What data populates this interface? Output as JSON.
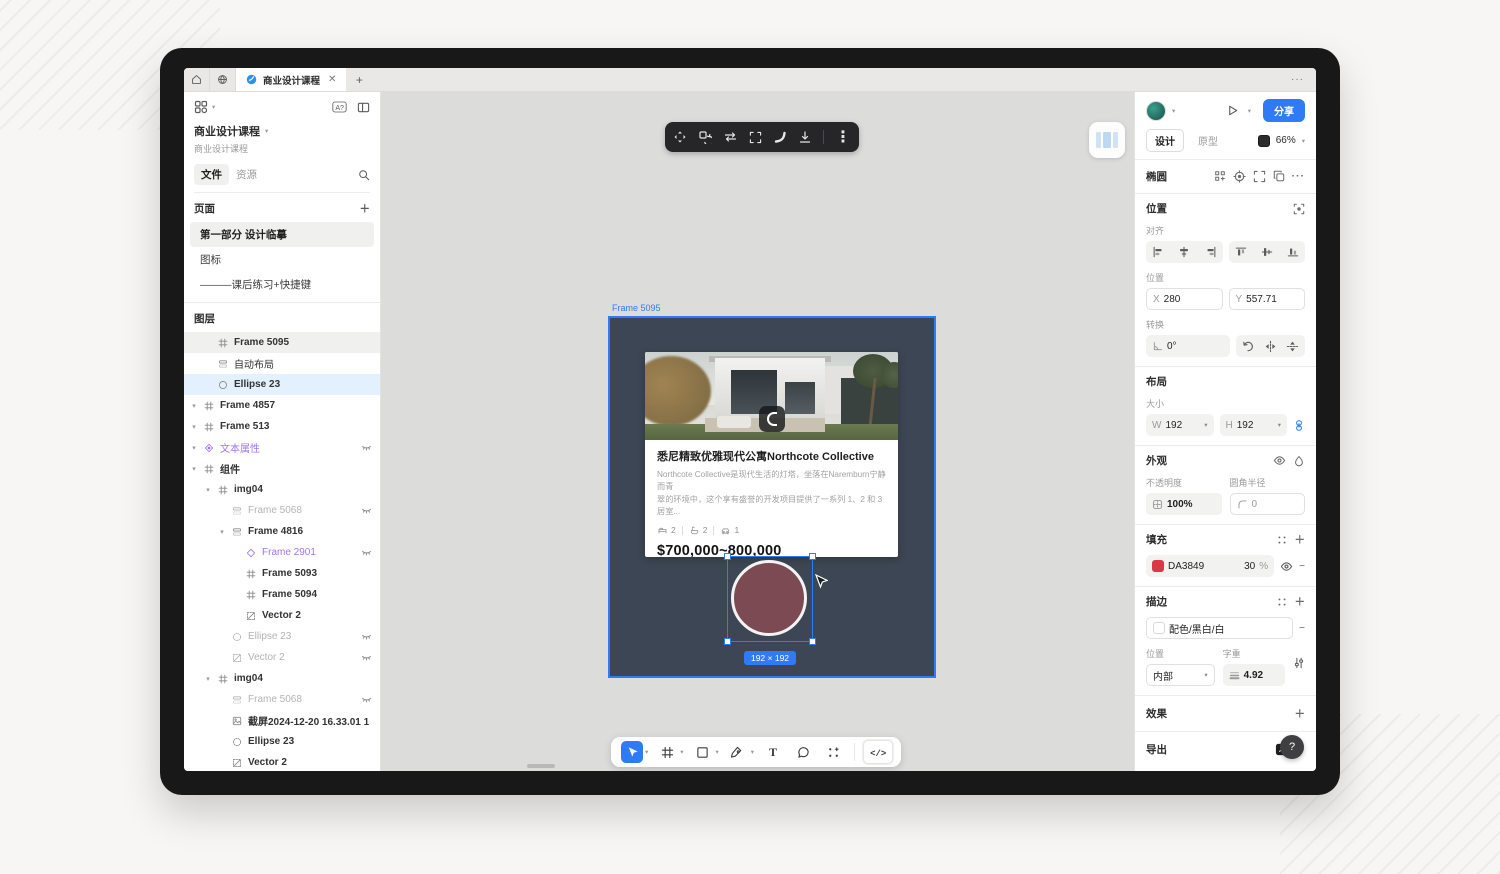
{
  "topbar": {
    "tab_title": "商业设计课程",
    "more": "···"
  },
  "sidebar": {
    "doc_title": "商业设计课程",
    "doc_subtitle": "商业设计课程",
    "tab_files": "文件",
    "tab_assets": "资源",
    "pages_header": "页面",
    "pages": [
      {
        "name": "第一部分 设计临摹",
        "active": true
      },
      {
        "name": "图标",
        "active": false
      },
      {
        "name": "———课后练习+快捷键",
        "active": false
      }
    ],
    "layers_header": "图层",
    "layers": [
      {
        "name": "Frame 5095",
        "indent": 1,
        "icon": "frame",
        "bg": "gray",
        "bold": true
      },
      {
        "name": "自动布局",
        "indent": 1,
        "icon": "autolayout"
      },
      {
        "name": "Ellipse 23",
        "indent": 1,
        "icon": "ellipse",
        "bg": "blue",
        "bold": true
      },
      {
        "name": "Frame 4857",
        "indent": 0,
        "icon": "frame",
        "caret": true,
        "bold": true
      },
      {
        "name": "Frame 513",
        "indent": 0,
        "icon": "frame",
        "caret": true,
        "bold": true
      },
      {
        "name": "文本属性",
        "indent": 0,
        "icon": "component",
        "color": "purple",
        "hidden": true,
        "caret": true
      },
      {
        "name": "组件",
        "indent": 0,
        "icon": "frame",
        "caret": true,
        "bold": true
      },
      {
        "name": "img04",
        "indent": 1,
        "icon": "frame",
        "caret": true,
        "bold": true
      },
      {
        "name": "Frame 5068",
        "indent": 2,
        "icon": "autolayout",
        "color": "gray",
        "hidden": true
      },
      {
        "name": "Frame 4816",
        "indent": 2,
        "icon": "autolayout",
        "caret": true,
        "bold": true
      },
      {
        "name": "Frame 2901",
        "indent": 3,
        "icon": "diamond",
        "color": "purple",
        "hidden": true
      },
      {
        "name": "Frame 5093",
        "indent": 3,
        "icon": "frame",
        "bold": true
      },
      {
        "name": "Frame 5094",
        "indent": 3,
        "icon": "frame",
        "bold": true
      },
      {
        "name": "Vector 2",
        "indent": 3,
        "icon": "vector",
        "bold": true
      },
      {
        "name": "Ellipse 23",
        "indent": 2,
        "icon": "ellipse-dashed",
        "color": "gray",
        "hidden": true
      },
      {
        "name": "Vector 2",
        "indent": 2,
        "icon": "vector",
        "color": "gray",
        "hidden": true
      },
      {
        "name": "img04",
        "indent": 1,
        "icon": "frame",
        "caret": true,
        "bold": true
      },
      {
        "name": "Frame 5068",
        "indent": 2,
        "icon": "autolayout",
        "color": "gray",
        "hidden": true
      },
      {
        "name": "截屏2024-12-20 16.33.01 1",
        "indent": 2,
        "icon": "image",
        "bold": true
      },
      {
        "name": "Ellipse 23",
        "indent": 2,
        "icon": "ellipse-dashed",
        "bold": true
      },
      {
        "name": "Vector 2",
        "indent": 2,
        "icon": "vector",
        "bold": true
      },
      {
        "name": "「框架」可以无限嵌套",
        "indent": 2,
        "icon": "text"
      }
    ]
  },
  "canvas": {
    "frame_label": "Frame 5095",
    "top_tools": [
      "move-icon",
      "rotate-copy-icon",
      "swap-arrows-icon",
      "frame-brackets-icon",
      "curve-icon",
      "export-download-icon",
      "more-vertical-icon"
    ],
    "bottom_tools": [
      {
        "icon": "cursor-icon",
        "active": true,
        "dropdown": true
      },
      {
        "icon": "frame-tool-icon",
        "active": false,
        "dropdown": true
      },
      {
        "icon": "shape-tool-icon",
        "active": false,
        "dropdown": true
      },
      {
        "icon": "pen-tool-icon",
        "active": false,
        "dropdown": true
      },
      {
        "icon": "text-tool-icon",
        "active": false,
        "dropdown": false
      },
      {
        "icon": "comment-tool-icon",
        "active": false,
        "dropdown": false
      },
      {
        "icon": "resources-tool-icon",
        "active": false,
        "dropdown": false
      }
    ],
    "card": {
      "title": "悉尼精致优雅现代公寓Northcote Collective",
      "desc1": "Northcote Collective是现代生活的灯塔，坐落在Naremburn宁静而青",
      "desc2": "翠的环境中，这个享有盛誉的开发项目提供了一系列 1、2 和 3 居室...",
      "amenities": [
        {
          "icon": "bed-icon",
          "count": "2"
        },
        {
          "icon": "bath-icon",
          "count": "2"
        },
        {
          "icon": "car-icon",
          "count": "1"
        }
      ],
      "price": "$700,000~800,000"
    },
    "size_badge": "192 × 192",
    "colors": {
      "frame_bg": "#3D4654",
      "circle_fill": "#7B4A52",
      "selection_blue": "#2F7BF6"
    }
  },
  "inspector": {
    "share": "分享",
    "tab_design": "设计",
    "tab_prototype": "原型",
    "zoom": "66%",
    "selection_title": "椭圆",
    "selection_tools": [
      "instance-icon",
      "target-icon",
      "frame-brackets-icon",
      "copy-icon",
      "more-dots-icon"
    ],
    "position": {
      "header": "位置",
      "align_label": "对齐",
      "align_tools": [
        "align-left-icon",
        "align-center-h-icon",
        "align-right-icon",
        "align-top-icon",
        "align-center-v-icon",
        "align-bottom-icon"
      ],
      "pos_label": "位置",
      "x_prefix": "X",
      "x": "280",
      "y_prefix": "Y",
      "y": "557.71",
      "transform_label": "转换",
      "rotation": "0°",
      "transform_tools": [
        "rotate-ccw-icon",
        "flip-h-icon",
        "flip-v-icon"
      ]
    },
    "layout": {
      "header": "布局",
      "size_label": "大小",
      "w_prefix": "W",
      "w": "192",
      "h_prefix": "H",
      "h": "192"
    },
    "appearance": {
      "header": "外观",
      "opacity_label": "不透明度",
      "opacity": "100%",
      "radius_label": "圆角半径",
      "radius": "0"
    },
    "fill": {
      "header": "填充",
      "hex": "DA3849",
      "opacity": "30",
      "unit": "%",
      "swatch": "#DA3849"
    },
    "stroke": {
      "header": "描边",
      "style": "配色/黑白/白",
      "pos_label": "位置",
      "pos_value": "内部",
      "weight_label": "字重",
      "weight": "4.92"
    },
    "effects_header": "效果",
    "export_header": "导出",
    "help": "?"
  }
}
